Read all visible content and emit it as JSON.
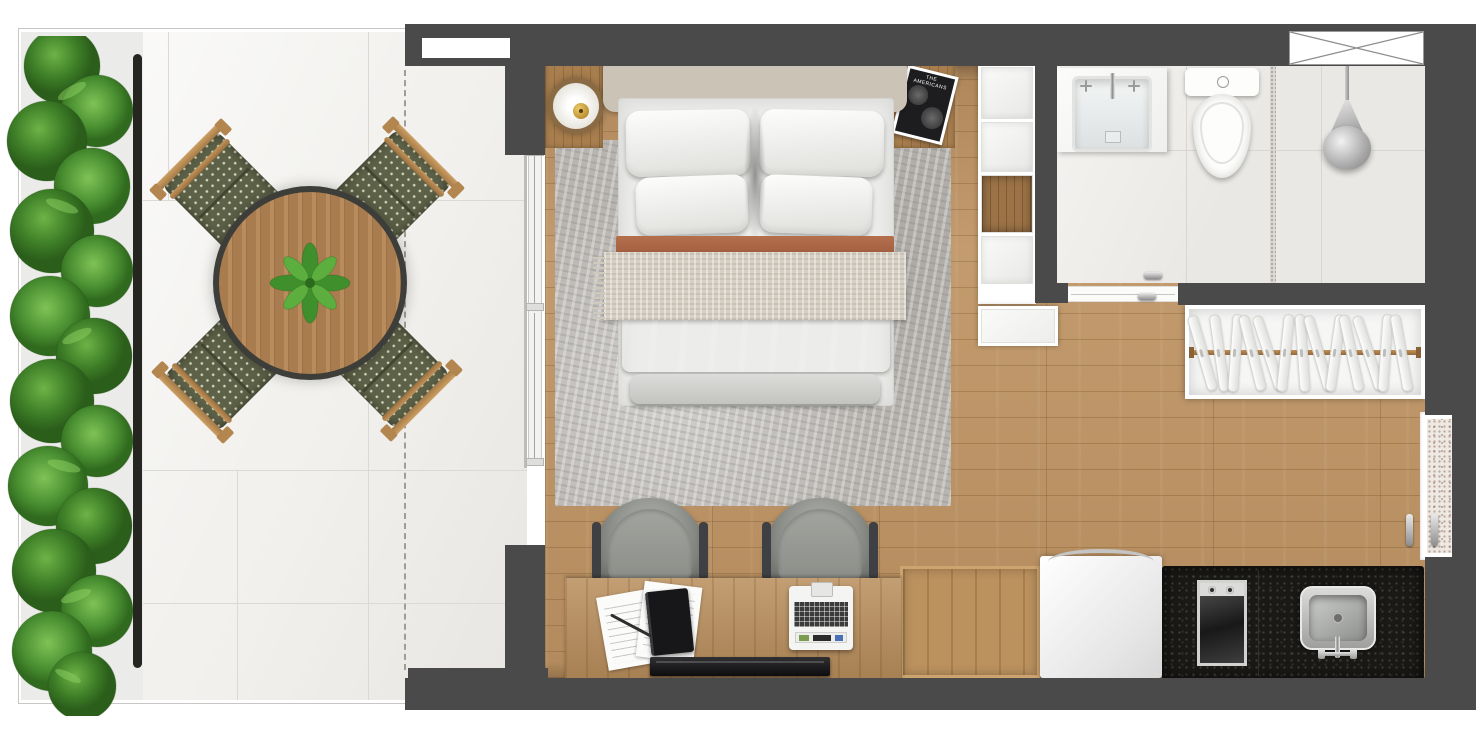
{
  "scene": {
    "kind": "studio-apartment-floor-plan",
    "view": "top-down-render"
  },
  "palette": {
    "wall": "#4a4a4b",
    "wood_floor": "#bf9565",
    "terrace_tile": "#f2f1ee",
    "rug": "#b8b5b1",
    "granite_counter": "#1a1916",
    "terracotta": "#ae6547",
    "hedge_green": "#3f7c2f",
    "table_wood": "#ad8052"
  },
  "terrace": {
    "chair_count": 4,
    "table": "round-wood-slat-table",
    "centerpiece": "potted-plant",
    "hedge": "leafy-planter-hedge",
    "boundary": "dashed-projection-line"
  },
  "bedroom": {
    "pillow_count": 4,
    "layers": [
      "white-duvet",
      "terracotta-edge",
      "cream-throw",
      "terracotta-blanket",
      "gray-bench"
    ],
    "nightstand_count": 2,
    "lamp": "round-brass-lamp",
    "magazine": {
      "title": "THE AMERICANS"
    },
    "rug": "gray-distressed-rug",
    "shelf_cells": [
      "white",
      "white",
      "wood",
      "white",
      "white-wide"
    ]
  },
  "bathroom": {
    "fixtures": [
      "vanity-sink",
      "toilet",
      "shower"
    ],
    "door": "sliding-pocket-door",
    "duct_marker": "crossed-box"
  },
  "closet": {
    "hangers": 13,
    "rod": "wood-rod"
  },
  "kitchen": {
    "appliances": [
      "refrigerator",
      "cooktop",
      "sink"
    ],
    "cooktop_knobs": 2,
    "counter": "black-granite"
  },
  "workspace": {
    "chair_count": 2,
    "desk_items": [
      "papers",
      "notebook",
      "pen",
      "portable-keyboard",
      "tv"
    ]
  },
  "entry": {
    "handle_count": 2,
    "outside_floor": "speckled-granite"
  }
}
